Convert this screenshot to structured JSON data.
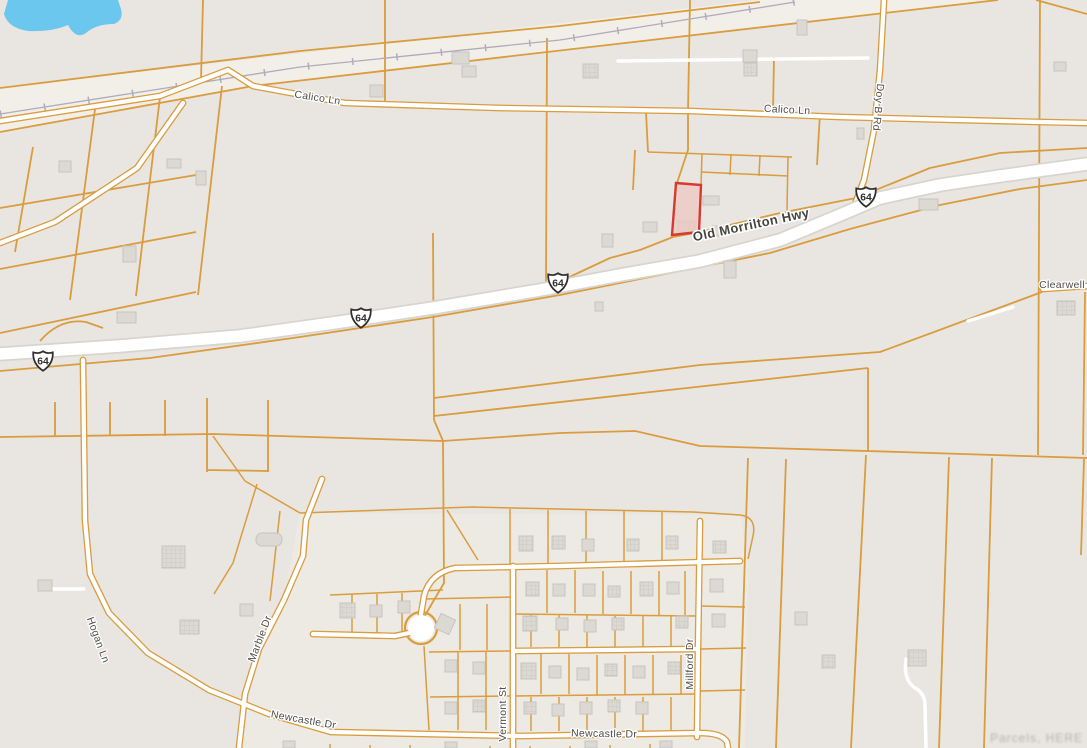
{
  "map": {
    "type": "parcel-boundary-map",
    "road_labels": {
      "calico_ln": "Calico Ln",
      "doy_b_rd": "Doy B Rd",
      "old_morrilton_hwy": "Old Morrilton Hwy",
      "clearwell": "Clearwell",
      "hogan_ln": "Hogan Ln",
      "marble_dr": "Marble Dr",
      "newcastle_dr": "Newcastle Dr",
      "vermont_st": "Vermont St",
      "millford_dr": "Millford Dr"
    },
    "route_shields": {
      "us_64": "64",
      "count": 4
    },
    "highlighted_parcel": {
      "status": "selected",
      "outline": "red"
    },
    "watermark": "Parcels, HERE",
    "colors": {
      "background": "#e9e6e1",
      "parcel_line": "#d99c3e",
      "road": "#ffffff",
      "water": "#6cc7ee",
      "highlight_stroke": "#d63a2f",
      "highlight_fill": "#eec7c2",
      "label": "#4f4e4b",
      "railroad": "#aeacbc"
    }
  }
}
